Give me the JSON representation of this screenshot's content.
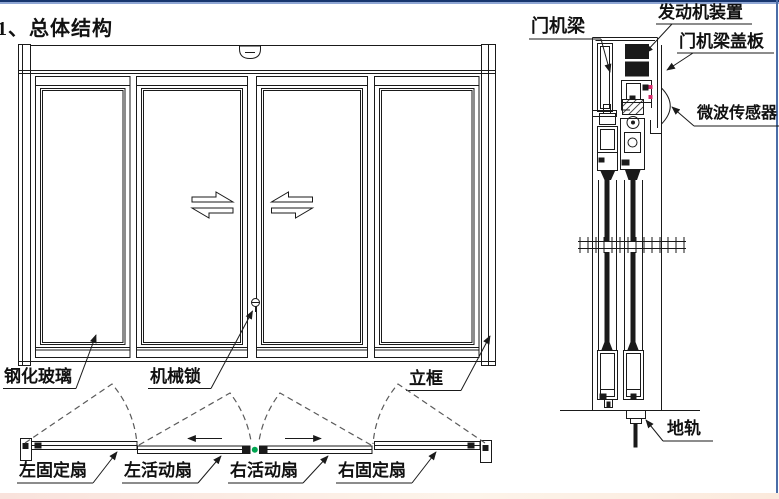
{
  "title": "1、总体结构",
  "front_view": {
    "labels": {
      "glass": "钢化玻璃",
      "lock": "机械锁",
      "frame": "立框"
    }
  },
  "plan_view": {
    "labels": {
      "left_fixed": "左固定扇",
      "left_active": "左活动扇",
      "right_active": "右活动扇",
      "right_fixed": "右固定扇"
    }
  },
  "section_view": {
    "labels": {
      "beam": "门机梁",
      "engine": "发动机装置",
      "cover": "门机梁盖板",
      "sensor": "微波传感器",
      "floor_track": "地轨"
    }
  },
  "colors": {
    "line": "#1a1a1a",
    "dashed_line": "#5a5a5a",
    "accent_green": "#00a651",
    "accent_red": "#d42a6a",
    "top_border_dark": "#17356e",
    "top_border_light": "#8fa6d4",
    "right_border": "#4a6da7",
    "bottom_strip": "#f9e2dc"
  }
}
